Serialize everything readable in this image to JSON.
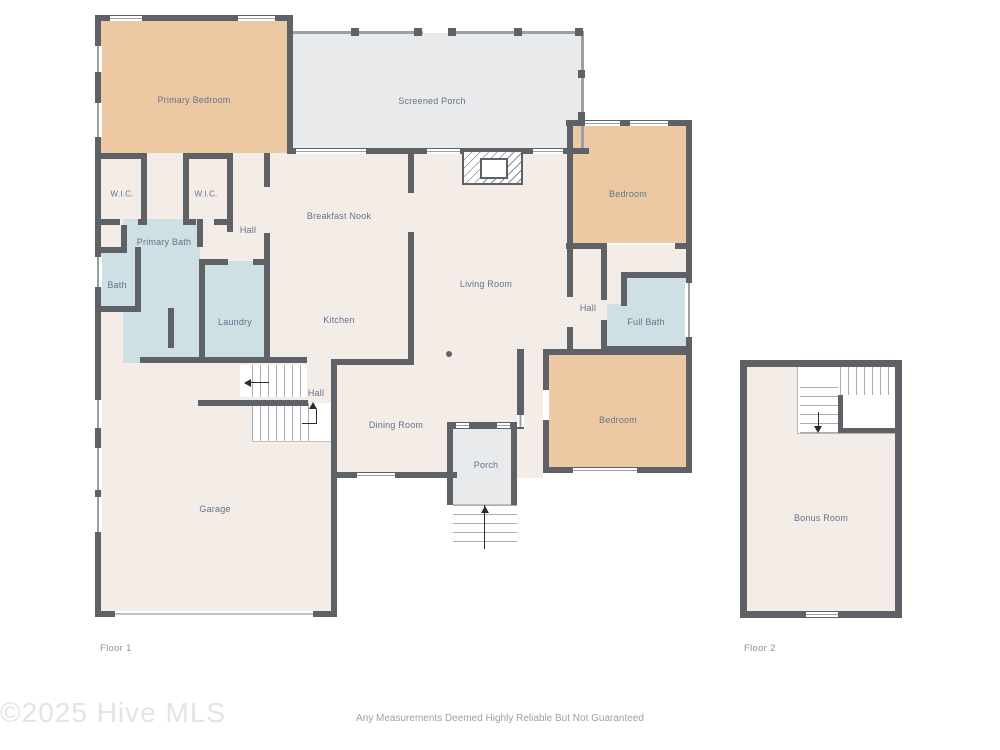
{
  "page": {
    "floor1_label": "Floor 1",
    "floor2_label": "Floor 2",
    "watermark": "©2025 Hive MLS",
    "disclaimer": "Any Measurements Deemed Highly Reliable But Not Guaranteed"
  },
  "rooms": {
    "primary_bedroom": "Primary Bedroom",
    "screened_porch": "Screened Porch",
    "wic": "W.I.C.",
    "hall": "Hall",
    "breakfast_nook": "Breakfast Nook",
    "bedroom": "Bedroom",
    "primary_bath": "Primary Bath",
    "bath": "Bath",
    "living_room": "Living Room",
    "full_bath": "Full Bath",
    "laundry": "Laundry",
    "kitchen": "Kitchen",
    "dining_room": "Dining Room",
    "porch": "Porch",
    "garage": "Garage",
    "bonus_room": "Bonus Room"
  },
  "colors": {
    "wall": "#5e6266",
    "floor_default": "#f3ece7",
    "bedroom_fill": "#ecc9a3",
    "bath_fill": "#cfe0e4",
    "porch_fill": "#e8eaec",
    "label_text": "#64748b"
  }
}
